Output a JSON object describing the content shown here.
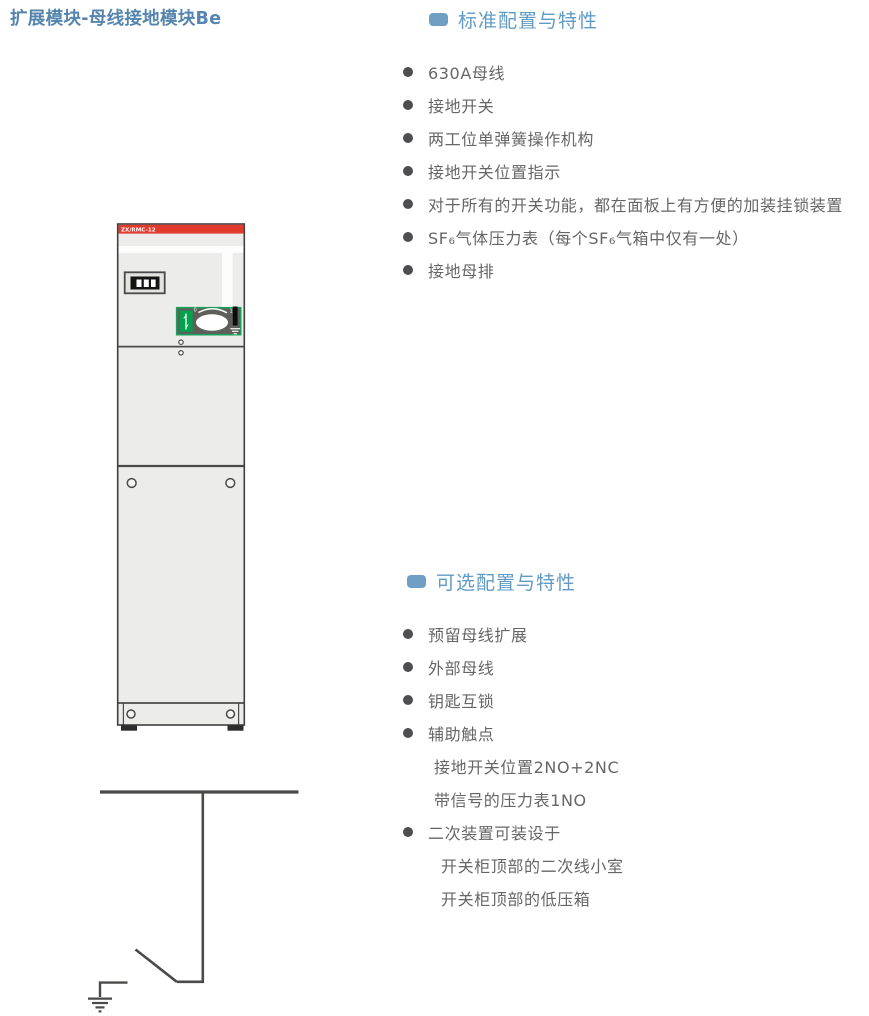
{
  "title": "扩展模块-母线接地模块Be",
  "sections": {
    "standard": {
      "title": "标准配置与特性",
      "items": [
        "630A母线",
        "接地开关",
        "两工位单弹簧操作机构",
        "接地开关位置指示",
        "对于所有的开关功能，都在面板上有方便的加装挂锁装置",
        "SF₆气体压力表（每个SF₆气箱中仅有一处）",
        "接地母排"
      ]
    },
    "optional": {
      "title": "可选配置与特性",
      "items": [
        {
          "text": "预留母线扩展"
        },
        {
          "text": "外部母线"
        },
        {
          "text": "钥匙互锁"
        },
        {
          "text": "辅助触点"
        },
        {
          "text": "接地开关位置2NO+2NC"
        },
        {
          "text": "带信号的压力表1NO"
        },
        {
          "text": "二次装置可装设于"
        },
        {
          "text": "开关柜顶部的二次线小室"
        },
        {
          "text": "开关柜顶部的低压箱"
        }
      ]
    }
  },
  "cabinet": {
    "model_label": "ZX/RMC-12",
    "knob_off_label": "0",
    "knob_on_label": "1"
  },
  "icons": {
    "section_marker": "rounded-square",
    "list_marker": "filled-circle",
    "schematic": "busbar-earthing-switch-symbol"
  },
  "colors": {
    "title_blue": "#5585ae",
    "header_blue": "#609bc6",
    "header_icon_blue": "#6f9fc5",
    "body_text_gray": "#666666",
    "bullet_gray": "#4e4e50",
    "cabinet_red": "#e23b2e",
    "cabinet_body_gray": "#ecedea",
    "panel_border_green": "#19a05a",
    "indicator_green": "#00a24e",
    "line_dark": "#4a4a48"
  }
}
